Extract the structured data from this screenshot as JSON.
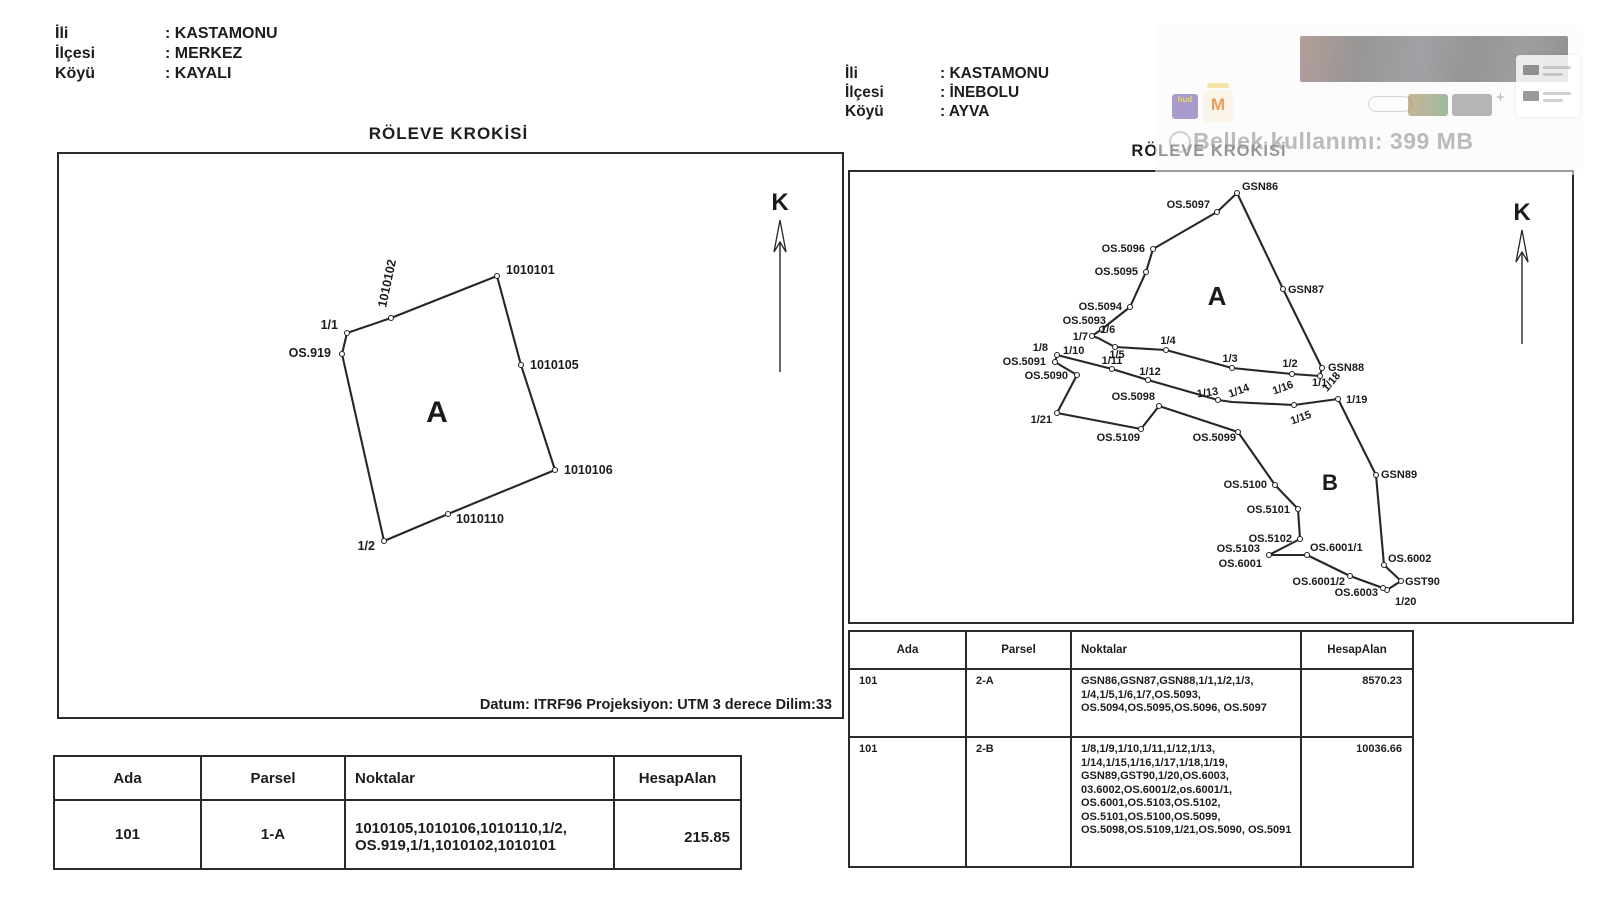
{
  "doc_left": {
    "meta": [
      {
        "label": "İli",
        "value": ": KASTAMONU"
      },
      {
        "label": "İlçesi",
        "value": ": MERKEZ"
      },
      {
        "label": "Köyü",
        "value": ": KAYALI"
      }
    ],
    "title": "RÖLEVE KROKİSİ",
    "datum": "Datum: ITRF96 Projeksiyon: UTM 3 derece Dilim:33",
    "table": {
      "headers": [
        "Ada",
        "Parsel",
        "Noktalar",
        "HesapAlan"
      ],
      "rows": [
        [
          "101",
          "1-A",
          "1010105,1010106,1010110,1/2, OS.919,1/1,1010102,1010101",
          "215.85"
        ]
      ]
    },
    "sketch": {
      "w": 783,
      "h": 563,
      "label_fs": 12.5,
      "stroke": "#26262b",
      "north": {
        "label": "K",
        "x": 721,
        "label_y": 56,
        "tip_y": 66,
        "tail_y": 218
      },
      "region_labels": [
        {
          "t": "A",
          "x": 378,
          "y": 268,
          "fs": 30
        }
      ],
      "polygons": [
        {
          "name": "parcel-1A",
          "points": [
            [
              438,
              122
            ],
            [
              332,
              164
            ],
            [
              288,
              179
            ],
            [
              283,
              200
            ],
            [
              325,
              387
            ],
            [
              389,
              360
            ],
            [
              496,
              316
            ],
            [
              462,
              211
            ]
          ]
        }
      ],
      "vertices": [
        {
          "n": "1010101",
          "x": 438,
          "y": 122
        },
        {
          "n": "1010102",
          "x": 332,
          "y": 164
        },
        {
          "n": "1-1",
          "x": 288,
          "y": 179
        },
        {
          "n": "OS.919",
          "x": 283,
          "y": 200
        },
        {
          "n": "1010105",
          "x": 462,
          "y": 211
        },
        {
          "n": "1010106",
          "x": 496,
          "y": 316
        },
        {
          "n": "1010110",
          "x": 389,
          "y": 360
        },
        {
          "n": "1-2",
          "x": 325,
          "y": 387
        }
      ],
      "labels": [
        {
          "t": "1010101",
          "x": 447,
          "y": 120,
          "a": "start"
        },
        {
          "t": "1010102",
          "x": 327,
          "y": 154,
          "a": "start",
          "rot": -78
        },
        {
          "t": "1/1",
          "x": 279,
          "y": 175,
          "a": "end"
        },
        {
          "t": "OS.919",
          "x": 272,
          "y": 203,
          "a": "end"
        },
        {
          "t": "1010105",
          "x": 471,
          "y": 215,
          "a": "start"
        },
        {
          "t": "1010106",
          "x": 505,
          "y": 320,
          "a": "start"
        },
        {
          "t": "1010110",
          "x": 397,
          "y": 369,
          "a": "start"
        },
        {
          "t": "1/2",
          "x": 316,
          "y": 396,
          "a": "end"
        }
      ]
    }
  },
  "doc_right": {
    "meta": [
      {
        "label": "İli",
        "value": ": KASTAMONU"
      },
      {
        "label": "İlçesi",
        "value": ": İNEBOLU"
      },
      {
        "label": "Köyü",
        "value": ": AYVA"
      }
    ],
    "title": "RÖLEVE KROKİSİ",
    "table": {
      "headers": [
        "Ada",
        "Parsel",
        "Noktalar",
        "HesapAlan"
      ],
      "rows": [
        [
          "101",
          "2-A",
          "GSN86,GSN87,GSN88,1/1,1/2,1/3, 1/4,1/5,1/6,1/7,OS.5093, OS.5094,OS.5095,OS.5096, OS.5097",
          "8570.23"
        ],
        [
          "101",
          "2-B",
          "1/8,1/9,1/10,1/11,1/12,1/13, 1/14,1/15,1/16,1/17,1/18,1/19, GSN89,GST90,1/20,OS.6003, 03.6002,OS.6001/2,os.6001/1, OS.6001,OS.5103,OS.5102, OS.5101,OS.5100,OS.5099, OS.5098,OS.5109,1/21,OS.5090, OS.5091",
          "10036.66"
        ]
      ]
    },
    "sketch": {
      "w": 722,
      "h": 450,
      "label_fs": 11,
      "stroke": "#26262b",
      "north": {
        "label": "K",
        "x": 672,
        "label_y": 48,
        "tip_y": 58,
        "tail_y": 172
      },
      "region_labels": [
        {
          "t": "A",
          "x": 367,
          "y": 133,
          "fs": 26
        },
        {
          "t": "B",
          "x": 480,
          "y": 318,
          "fs": 22
        }
      ],
      "polygons": [
        {
          "name": "parcel-2A",
          "points": [
            [
              387,
              21
            ],
            [
              433,
              117
            ],
            [
              472,
              196
            ],
            [
              470,
              204
            ],
            [
              442,
              202
            ],
            [
              382,
              196
            ],
            [
              316,
              178
            ],
            [
              265,
              175
            ],
            [
              248,
              166
            ],
            [
              242,
              164
            ],
            [
              252,
              157
            ],
            [
              280,
              135
            ],
            [
              296,
              100
            ],
            [
              303,
              77
            ],
            [
              367,
              40
            ]
          ]
        },
        {
          "name": "parcel-2B",
          "points": [
            [
              207,
              183
            ],
            [
              262,
              197
            ],
            [
              298,
              208
            ],
            [
              368,
              228
            ],
            [
              382,
              230
            ],
            [
              444,
              233
            ],
            [
              488,
              227
            ],
            [
              526,
              303
            ],
            [
              534,
              393
            ],
            [
              551,
              409
            ],
            [
              537,
              418
            ],
            [
              533,
              416
            ],
            [
              500,
              404
            ],
            [
              457,
              383
            ],
            [
              419,
              383
            ],
            [
              450,
              367
            ],
            [
              448,
              337
            ],
            [
              425,
              313
            ],
            [
              388,
              260
            ],
            [
              309,
              234
            ],
            [
              291,
              257
            ],
            [
              207,
              241
            ],
            [
              227,
              203
            ],
            [
              205,
              190
            ]
          ]
        }
      ],
      "vertices": [
        {
          "n": "GSN86",
          "x": 387,
          "y": 21
        },
        {
          "n": "OS.5097",
          "x": 367,
          "y": 40
        },
        {
          "n": "OS.5096",
          "x": 303,
          "y": 77
        },
        {
          "n": "OS.5095",
          "x": 296,
          "y": 100
        },
        {
          "n": "OS.5094",
          "x": 280,
          "y": 135
        },
        {
          "n": "OS.5093",
          "x": 252,
          "y": 157
        },
        {
          "n": "1-7",
          "x": 242,
          "y": 164
        },
        {
          "n": "1-5",
          "x": 265,
          "y": 175
        },
        {
          "n": "1-4",
          "x": 316,
          "y": 178
        },
        {
          "n": "1-3",
          "x": 382,
          "y": 196
        },
        {
          "n": "1-2",
          "x": 442,
          "y": 202
        },
        {
          "n": "GSN88",
          "x": 472,
          "y": 196
        },
        {
          "n": "GSN87",
          "x": 433,
          "y": 117
        },
        {
          "n": "1-1",
          "x": 470,
          "y": 204
        },
        {
          "n": "1-8",
          "x": 207,
          "y": 183
        },
        {
          "n": "OS.5091",
          "x": 205,
          "y": 190
        },
        {
          "n": "OS.5090",
          "x": 227,
          "y": 203
        },
        {
          "n": "1-11",
          "x": 262,
          "y": 197
        },
        {
          "n": "1-12",
          "x": 298,
          "y": 208
        },
        {
          "n": "1-13",
          "x": 368,
          "y": 228
        },
        {
          "n": "1-16",
          "x": 444,
          "y": 233
        },
        {
          "n": "1-19",
          "x": 488,
          "y": 227
        },
        {
          "n": "GSN89",
          "x": 526,
          "y": 303
        },
        {
          "n": "OS.6002",
          "x": 534,
          "y": 393
        },
        {
          "n": "GST90",
          "x": 551,
          "y": 409
        },
        {
          "n": "1-20",
          "x": 537,
          "y": 418
        },
        {
          "n": "OS.6003",
          "x": 533,
          "y": 416
        },
        {
          "n": "OS.6001-2",
          "x": 500,
          "y": 404
        },
        {
          "n": "OS.6001-1",
          "x": 457,
          "y": 383
        },
        {
          "n": "OS.6001",
          "x": 419,
          "y": 383
        },
        {
          "n": "OS.5102",
          "x": 450,
          "y": 367
        },
        {
          "n": "OS.5101",
          "x": 448,
          "y": 337
        },
        {
          "n": "OS.5100",
          "x": 425,
          "y": 313
        },
        {
          "n": "OS.5099",
          "x": 388,
          "y": 260
        },
        {
          "n": "OS.5098",
          "x": 309,
          "y": 234
        },
        {
          "n": "OS.5109",
          "x": 291,
          "y": 257
        },
        {
          "n": "1-21",
          "x": 207,
          "y": 241
        }
      ],
      "labels": [
        {
          "t": "GSN86",
          "x": 392,
          "y": 18,
          "a": "start"
        },
        {
          "t": "OS.5097",
          "x": 360,
          "y": 36,
          "a": "end"
        },
        {
          "t": "OS.5096",
          "x": 295,
          "y": 80,
          "a": "end"
        },
        {
          "t": "OS.5095",
          "x": 288,
          "y": 103,
          "a": "end"
        },
        {
          "t": "OS.5094",
          "x": 272,
          "y": 138,
          "a": "end"
        },
        {
          "t": "OS.5093",
          "x": 256,
          "y": 152,
          "a": "end"
        },
        {
          "t": "1/7",
          "x": 238,
          "y": 168,
          "a": "end"
        },
        {
          "t": "1/6",
          "x": 250,
          "y": 161,
          "a": "start"
        },
        {
          "t": "1/5",
          "x": 267,
          "y": 186,
          "a": "middle"
        },
        {
          "t": "1/4",
          "x": 318,
          "y": 172,
          "a": "middle"
        },
        {
          "t": "1/3",
          "x": 380,
          "y": 190,
          "a": "middle"
        },
        {
          "t": "1/2",
          "x": 440,
          "y": 195,
          "a": "middle"
        },
        {
          "t": "GSN88",
          "x": 478,
          "y": 199,
          "a": "start"
        },
        {
          "t": "1/1",
          "x": 462,
          "y": 214,
          "a": "start"
        },
        {
          "t": "GSN87",
          "x": 438,
          "y": 121,
          "a": "start"
        },
        {
          "t": "1/8",
          "x": 198,
          "y": 179,
          "a": "end"
        },
        {
          "t": "1/10",
          "x": 213,
          "y": 182,
          "a": "start"
        },
        {
          "t": "OS.5091",
          "x": 196,
          "y": 193,
          "a": "end"
        },
        {
          "t": "OS.5090",
          "x": 218,
          "y": 207,
          "a": "end"
        },
        {
          "t": "1/11",
          "x": 262,
          "y": 192,
          "a": "middle"
        },
        {
          "t": "1/12",
          "x": 300,
          "y": 203,
          "a": "middle"
        },
        {
          "t": "1/13",
          "x": 358,
          "y": 224,
          "a": "middle",
          "rot": -8
        },
        {
          "t": "1/14",
          "x": 390,
          "y": 222,
          "a": "middle",
          "rot": -20
        },
        {
          "t": "1/16",
          "x": 434,
          "y": 219,
          "a": "middle",
          "rot": -20
        },
        {
          "t": "1/15",
          "x": 452,
          "y": 249,
          "a": "middle",
          "rot": -20
        },
        {
          "t": "1/18",
          "x": 484,
          "y": 212,
          "a": "middle",
          "rot": -50
        },
        {
          "t": "1/19",
          "x": 496,
          "y": 231,
          "a": "start"
        },
        {
          "t": "GSN89",
          "x": 531,
          "y": 306,
          "a": "start"
        },
        {
          "t": "OS.5100",
          "x": 417,
          "y": 316,
          "a": "end"
        },
        {
          "t": "OS.5101",
          "x": 440,
          "y": 341,
          "a": "end"
        },
        {
          "t": "OS.5102",
          "x": 442,
          "y": 370,
          "a": "end"
        },
        {
          "t": "OS.5103",
          "x": 410,
          "y": 380,
          "a": "end"
        },
        {
          "t": "OS.6001",
          "x": 412,
          "y": 395,
          "a": "end"
        },
        {
          "t": "OS.6001/1",
          "x": 460,
          "y": 379,
          "a": "start"
        },
        {
          "t": "OS.6002",
          "x": 538,
          "y": 390,
          "a": "start"
        },
        {
          "t": "OS.6001/2",
          "x": 495,
          "y": 413,
          "a": "end"
        },
        {
          "t": "OS.6003",
          "x": 528,
          "y": 424,
          "a": "end"
        },
        {
          "t": "GST90",
          "x": 555,
          "y": 413,
          "a": "start"
        },
        {
          "t": "1/20",
          "x": 545,
          "y": 433,
          "a": "start"
        },
        {
          "t": "OS.5098",
          "x": 305,
          "y": 228,
          "a": "end"
        },
        {
          "t": "OS.5109",
          "x": 290,
          "y": 269,
          "a": "end"
        },
        {
          "t": "OS.5099",
          "x": 386,
          "y": 269,
          "a": "end"
        },
        {
          "t": "1/21",
          "x": 202,
          "y": 251,
          "a": "end"
        }
      ]
    }
  },
  "ghost_overlay": {
    "memory_text": "Bellek kullanımı: 399 MB",
    "hud_icon_text": "hud",
    "m_icon_text": "M",
    "plus_text": "+"
  }
}
